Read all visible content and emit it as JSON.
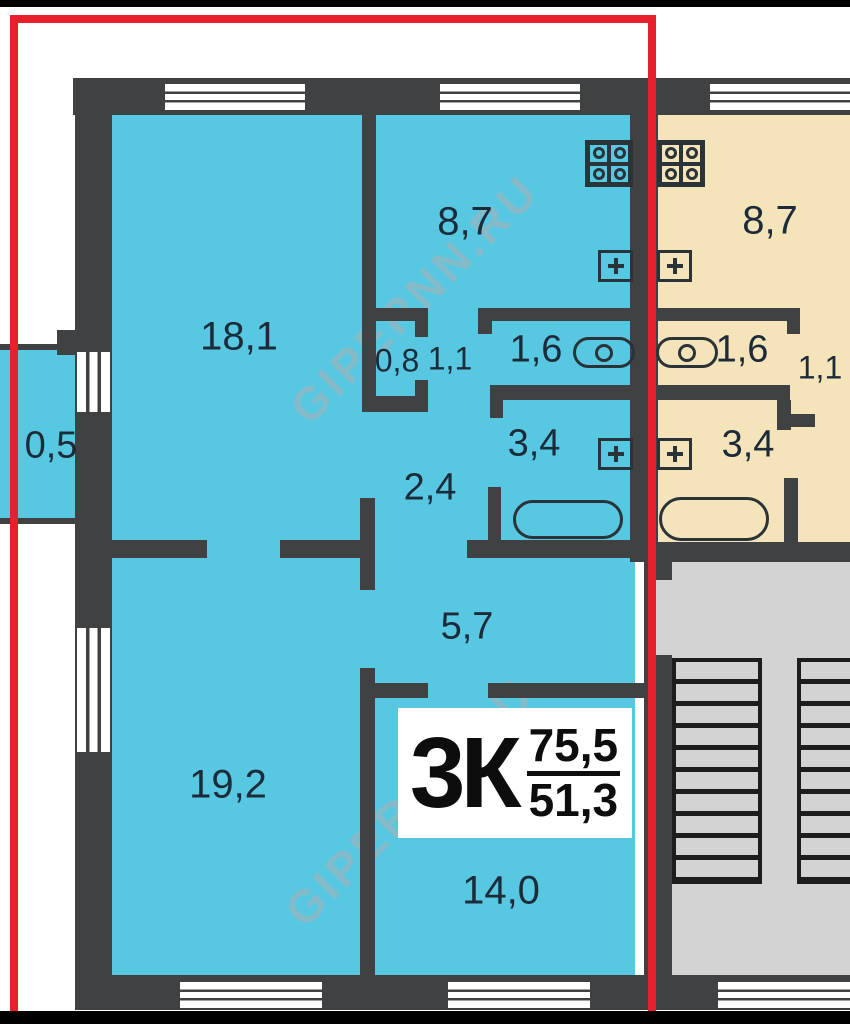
{
  "watermark": {
    "text": "GIPERNN.RU"
  },
  "unit_label": {
    "type": "3К",
    "area_total": "75,5",
    "area_living": "51,3"
  },
  "rooms": {
    "balcony": "0,5",
    "living_large": "18,1",
    "kitchen_left": "8,7",
    "closet_small": "0,8",
    "closet": "1,1",
    "wc_left": "1,6",
    "bath_left": "3,4",
    "hall_inner": "2,4",
    "hall_main": "5,7",
    "living_mid": "19,2",
    "living_bottom": "14,0",
    "kitchen_right": "8,7",
    "wc_right": "1,6",
    "corridor_right": "1,1",
    "bath_right": "3,4"
  },
  "colors": {
    "wall": "#3f4142",
    "cyan": "#58c8e2",
    "beige": "#f5e4ba",
    "gray": "#d2d3d2",
    "red": "#e6212b",
    "ink": "#1c2b3a",
    "outline": "#2a3338",
    "stair": "#1d1d1d",
    "wm": "#aab0b4"
  }
}
